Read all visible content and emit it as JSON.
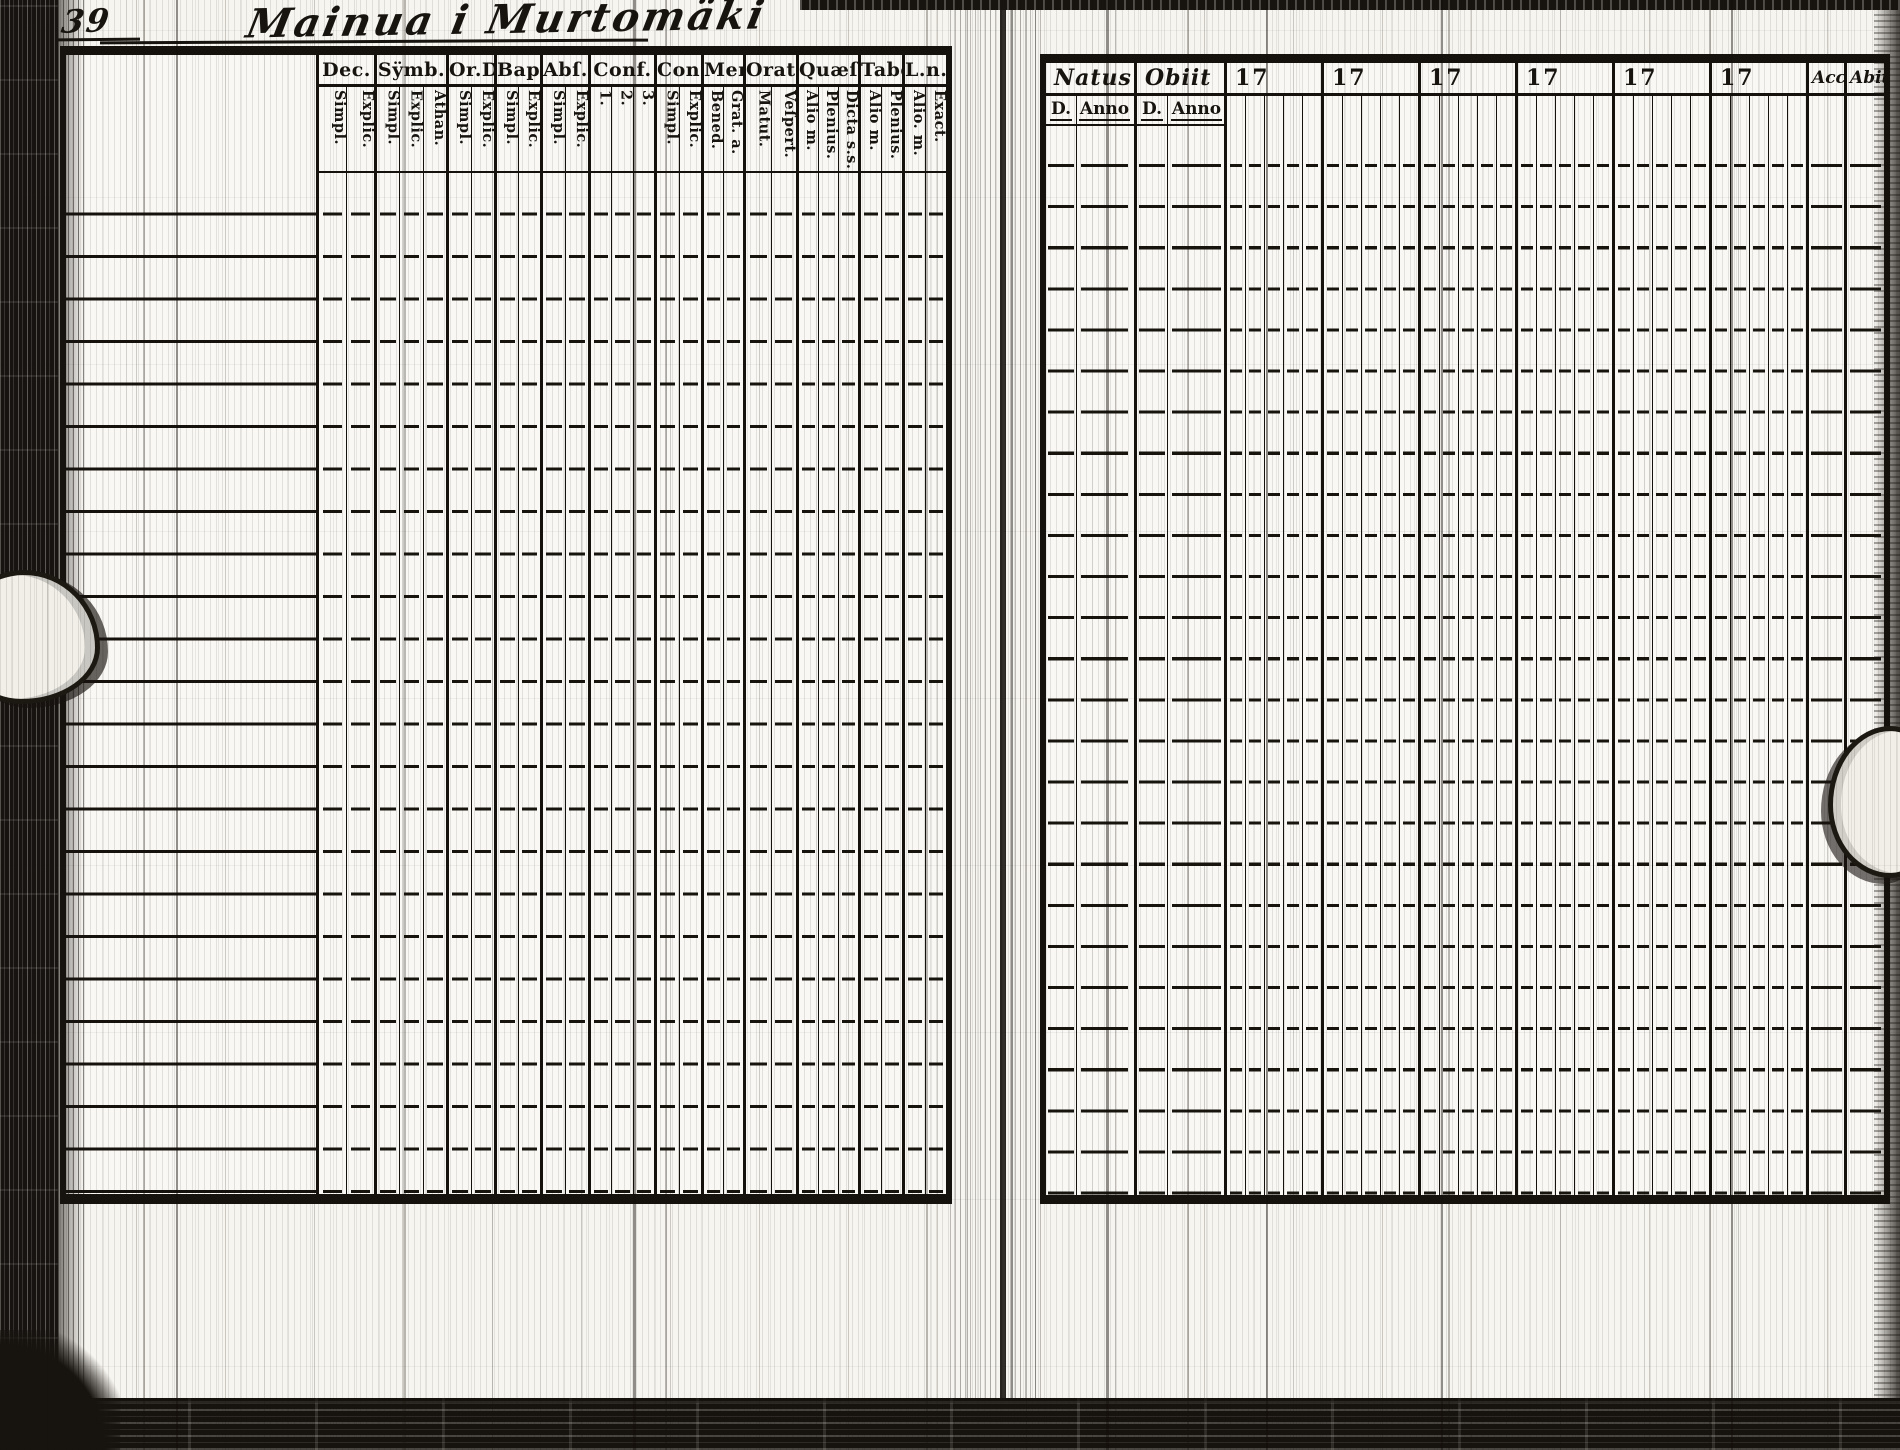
{
  "page": {
    "folio_number": "39",
    "title": "Mainua i Murtomäki"
  },
  "left_table": {
    "description": "printed communion-examination grid",
    "columns": [
      {
        "label": "Dec.",
        "subs": [
          "Simpl.",
          "Explic."
        ]
      },
      {
        "label": "Sÿmb.",
        "subs": [
          "Simpl.",
          "Explic.",
          "Athan."
        ]
      },
      {
        "label": "Or.D",
        "subs": [
          "Simpl.",
          "Explic."
        ]
      },
      {
        "label": "Bapt.",
        "subs": [
          "Simpl.",
          "Explic."
        ]
      },
      {
        "label": "Abſ.",
        "subs": [
          "Simpl.",
          "Explic."
        ]
      },
      {
        "label": "Conf.",
        "subs": [
          "1.",
          "2.",
          "3."
        ]
      },
      {
        "label": "Con.D",
        "subs": [
          "Simpl.",
          "Explic."
        ]
      },
      {
        "label": "Menſ.",
        "subs": [
          "Bened.",
          "Grat. a."
        ]
      },
      {
        "label": "Orat.",
        "subs": [
          "Matut.",
          "Veſpert."
        ]
      },
      {
        "label": "Quæſt.",
        "subs": [
          "Alio m.",
          "Plenius.",
          "Dicta s.s."
        ]
      },
      {
        "label": "Tabel.",
        "subs": [
          "Alio m.",
          "Plenius."
        ]
      },
      {
        "label": "L.n.",
        "subs": [
          "Alio. m.",
          "Exact."
        ]
      }
    ],
    "row_count": 24
  },
  "right_table": {
    "description": "birth / death / yearly attendance grid",
    "natus": {
      "label": "Natus",
      "subs": [
        "D.",
        "Anno"
      ]
    },
    "obiit": {
      "label": "Obiit",
      "subs": [
        "D.",
        "Anno"
      ]
    },
    "year_prefix": "17",
    "year_column_count": 6,
    "acce_label": "Acceſ",
    "abit_label": "Abit",
    "row_count": 26
  }
}
